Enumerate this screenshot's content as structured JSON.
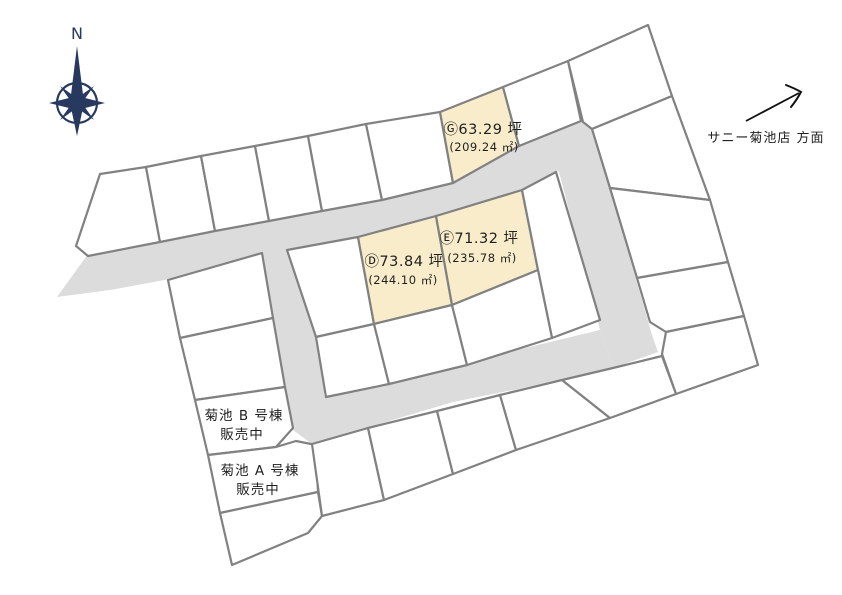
{
  "canvas": {
    "width": 842,
    "height": 595,
    "background": "#ffffff"
  },
  "palette": {
    "road_fill": "#dcdcdc",
    "lot_fill": "#ffffff",
    "lot_stroke": "#818181",
    "highlight_fill": "#f8ecca",
    "text_color": "#1f1f1f",
    "compass_color": "#27395e"
  },
  "compass": {
    "label": "N",
    "cx": 77,
    "cy": 103
  },
  "direction_sign": {
    "text": "サニー菊池店 方面",
    "text_x": 766,
    "text_y": 142,
    "font_size": 13,
    "arrow": {
      "x1": 746,
      "y1": 121,
      "x2": 799,
      "y2": 93
    }
  },
  "highlighted_lots_summary": [
    {
      "id": "lot-g",
      "tsubo": "Ⓖ63.29 坪",
      "area_m2": "(209.24 ㎡)"
    },
    {
      "id": "lot-e",
      "tsubo": "Ⓔ71.32 坪",
      "area_m2": "(235.78 ㎡)"
    },
    {
      "id": "lot-d",
      "tsubo": "Ⓓ73.84 坪",
      "area_m2": "(244.10 ㎡)"
    }
  ],
  "map": {
    "roads": [
      {
        "id": "upper-road",
        "points": [
          [
            57,
            297
          ],
          [
            88,
            254
          ],
          [
            170,
            240
          ],
          [
            280,
            219
          ],
          [
            360,
            203
          ],
          [
            382,
            200
          ],
          [
            452,
            184
          ],
          [
            519,
            146
          ],
          [
            581,
            121
          ],
          [
            590,
            124
          ],
          [
            600,
            160
          ],
          [
            556,
            172
          ],
          [
            522,
            190
          ],
          [
            436,
            216
          ],
          [
            358,
            237
          ],
          [
            287,
            250
          ],
          [
            170,
            279
          ],
          [
            110,
            290
          ]
        ]
      },
      {
        "id": "right-road",
        "points": [
          [
            558,
            168
          ],
          [
            592,
            126
          ],
          [
            652,
            335
          ],
          [
            658,
            352
          ],
          [
            613,
            368
          ],
          [
            600,
            330
          ]
        ]
      },
      {
        "id": "lower-road",
        "points": [
          [
            313,
            398
          ],
          [
            450,
            366
          ],
          [
            600,
            330
          ],
          [
            613,
            368
          ],
          [
            513,
            390
          ],
          [
            453,
            402
          ],
          [
            312,
            444
          ],
          [
            296,
            428
          ]
        ]
      },
      {
        "id": "left-road",
        "points": [
          [
            262,
            253
          ],
          [
            295,
            247
          ],
          [
            326,
            386
          ],
          [
            312,
            444
          ],
          [
            293,
            430
          ]
        ]
      }
    ],
    "lots": [
      {
        "id": "lot-top-1",
        "type": "plain",
        "points": [
          [
            100,
            174
          ],
          [
            146,
            167
          ],
          [
            160,
            242
          ],
          [
            88,
            256
          ],
          [
            76,
            246
          ]
        ]
      },
      {
        "id": "lot-top-2",
        "type": "plain",
        "points": [
          [
            146,
            167
          ],
          [
            201,
            156
          ],
          [
            215,
            231
          ],
          [
            160,
            242
          ]
        ]
      },
      {
        "id": "lot-top-3",
        "type": "plain",
        "points": [
          [
            201,
            156
          ],
          [
            255,
            146
          ],
          [
            269,
            221
          ],
          [
            215,
            231
          ]
        ]
      },
      {
        "id": "lot-top-4",
        "type": "plain",
        "points": [
          [
            255,
            146
          ],
          [
            308,
            136
          ],
          [
            322,
            211
          ],
          [
            269,
            221
          ]
        ]
      },
      {
        "id": "lot-top-5",
        "type": "plain",
        "points": [
          [
            308,
            136
          ],
          [
            366,
            124
          ],
          [
            382,
            200
          ],
          [
            322,
            211
          ]
        ]
      },
      {
        "id": "lot-top-6",
        "type": "plain",
        "points": [
          [
            366,
            124
          ],
          [
            440,
            112
          ],
          [
            453,
            183
          ],
          [
            382,
            200
          ]
        ]
      },
      {
        "id": "lot-g",
        "type": "highlight",
        "points": [
          [
            440,
            112
          ],
          [
            503,
            87
          ],
          [
            519,
            146
          ],
          [
            453,
            183
          ]
        ],
        "label_lines": [
          {
            "text": "Ⓖ63.29 坪",
            "x": 483,
            "y": 134,
            "size": 14.5
          },
          {
            "text": "(209.24 ㎡)",
            "x": 484,
            "y": 151,
            "size": 11.5
          }
        ]
      },
      {
        "id": "lot-top-7",
        "type": "plain",
        "points": [
          [
            503,
            87
          ],
          [
            568,
            61
          ],
          [
            581,
            121
          ],
          [
            519,
            146
          ]
        ]
      },
      {
        "id": "lot-ne-corner",
        "type": "plain",
        "points": [
          [
            568,
            61
          ],
          [
            648,
            25
          ],
          [
            672,
            96
          ],
          [
            592,
            129
          ],
          [
            583,
            122
          ]
        ]
      },
      {
        "id": "lot-east-1",
        "type": "plain",
        "points": [
          [
            592,
            129
          ],
          [
            672,
            96
          ],
          [
            710,
            200
          ],
          [
            610,
            188
          ]
        ]
      },
      {
        "id": "lot-east-2",
        "type": "plain",
        "points": [
          [
            610,
            188
          ],
          [
            710,
            200
          ],
          [
            728,
            262
          ],
          [
            637,
            278
          ]
        ]
      },
      {
        "id": "lot-east-3",
        "type": "plain",
        "points": [
          [
            637,
            278
          ],
          [
            728,
            262
          ],
          [
            744,
            316
          ],
          [
            666,
            332
          ],
          [
            650,
            322
          ]
        ]
      },
      {
        "id": "lot-east-4",
        "type": "plain",
        "points": [
          [
            666,
            332
          ],
          [
            744,
            316
          ],
          [
            758,
            365
          ],
          [
            676,
            394
          ],
          [
            662,
            354
          ]
        ]
      },
      {
        "id": "lot-center-nw",
        "type": "plain",
        "points": [
          [
            287,
            250
          ],
          [
            358,
            237
          ],
          [
            374,
            324
          ],
          [
            316,
            337
          ]
        ]
      },
      {
        "id": "lot-d",
        "type": "highlight",
        "points": [
          [
            358,
            237
          ],
          [
            436,
            216
          ],
          [
            452,
            305
          ],
          [
            374,
            324
          ]
        ],
        "label_lines": [
          {
            "text": "Ⓓ73.84 坪",
            "x": 404,
            "y": 266,
            "size": 14.5
          },
          {
            "text": "(244.10 ㎡)",
            "x": 403,
            "y": 284,
            "size": 11.5
          }
        ]
      },
      {
        "id": "lot-e",
        "type": "highlight",
        "points": [
          [
            436,
            216
          ],
          [
            522,
            190
          ],
          [
            538,
            270
          ],
          [
            452,
            305
          ]
        ],
        "label_lines": [
          {
            "text": "Ⓔ71.32 坪",
            "x": 479,
            "y": 243,
            "size": 14.5
          },
          {
            "text": "(235.78 ㎡)",
            "x": 482,
            "y": 262,
            "size": 11.5
          }
        ]
      },
      {
        "id": "lot-center-e",
        "type": "plain",
        "points": [
          [
            522,
            190
          ],
          [
            556,
            172
          ],
          [
            600,
            320
          ],
          [
            552,
            338
          ],
          [
            538,
            270
          ]
        ]
      },
      {
        "id": "lot-center-s1",
        "type": "plain",
        "points": [
          [
            316,
            337
          ],
          [
            374,
            324
          ],
          [
            389,
            384
          ],
          [
            326,
            397
          ]
        ]
      },
      {
        "id": "lot-center-s2",
        "type": "plain",
        "points": [
          [
            374,
            324
          ],
          [
            452,
            305
          ],
          [
            467,
            365
          ],
          [
            389,
            384
          ]
        ]
      },
      {
        "id": "lot-center-s3",
        "type": "plain",
        "points": [
          [
            452,
            305
          ],
          [
            538,
            270
          ],
          [
            552,
            338
          ],
          [
            467,
            365
          ]
        ]
      },
      {
        "id": "lot-west-1",
        "type": "plain",
        "points": [
          [
            168,
            280
          ],
          [
            262,
            253
          ],
          [
            273,
            318
          ],
          [
            180,
            338
          ]
        ]
      },
      {
        "id": "lot-west-2",
        "type": "plain",
        "points": [
          [
            180,
            338
          ],
          [
            273,
            318
          ],
          [
            285,
            387
          ],
          [
            195,
            400
          ]
        ]
      },
      {
        "id": "lot-kikuchi-b",
        "type": "plain",
        "points": [
          [
            195,
            400
          ],
          [
            285,
            387
          ],
          [
            293,
            428
          ],
          [
            276,
            447
          ],
          [
            208,
            455
          ]
        ]
      },
      {
        "id": "lot-kikuchi-a",
        "type": "plain",
        "points": [
          [
            208,
            455
          ],
          [
            276,
            447
          ],
          [
            296,
            441
          ],
          [
            316,
            445
          ],
          [
            318,
            492
          ],
          [
            220,
            513
          ]
        ]
      },
      {
        "id": "lot-sw-corner",
        "type": "plain",
        "points": [
          [
            220,
            513
          ],
          [
            318,
            492
          ],
          [
            322,
            516
          ],
          [
            308,
            533
          ],
          [
            232,
            565
          ]
        ]
      },
      {
        "id": "lot-south-1",
        "type": "plain",
        "points": [
          [
            312,
            444
          ],
          [
            368,
            428
          ],
          [
            384,
            500
          ],
          [
            322,
            516
          ]
        ]
      },
      {
        "id": "lot-south-2",
        "type": "plain",
        "points": [
          [
            368,
            428
          ],
          [
            437,
            411
          ],
          [
            453,
            474
          ],
          [
            384,
            500
          ]
        ]
      },
      {
        "id": "lot-south-3",
        "type": "plain",
        "points": [
          [
            437,
            411
          ],
          [
            500,
            395
          ],
          [
            516,
            450
          ],
          [
            453,
            474
          ]
        ]
      },
      {
        "id": "lot-south-4",
        "type": "plain",
        "points": [
          [
            500,
            395
          ],
          [
            562,
            380
          ],
          [
            610,
            418
          ],
          [
            516,
            450
          ]
        ]
      },
      {
        "id": "lot-south-5",
        "type": "plain",
        "points": [
          [
            562,
            380
          ],
          [
            613,
            368
          ],
          [
            662,
            356
          ],
          [
            676,
            394
          ],
          [
            610,
            418
          ]
        ]
      }
    ],
    "texts": [
      {
        "id": "kikuchi-b-label",
        "lines": [
          {
            "text": "菊池 B 号棟",
            "x": 244,
            "y": 420,
            "size": 13.5
          },
          {
            "text": "販売中",
            "x": 242,
            "y": 439,
            "size": 13.5
          }
        ]
      },
      {
        "id": "kikuchi-a-label",
        "lines": [
          {
            "text": "菊池 A 号棟",
            "x": 260,
            "y": 475,
            "size": 13.5
          },
          {
            "text": "販売中",
            "x": 258,
            "y": 494,
            "size": 13.5
          }
        ]
      }
    ]
  }
}
